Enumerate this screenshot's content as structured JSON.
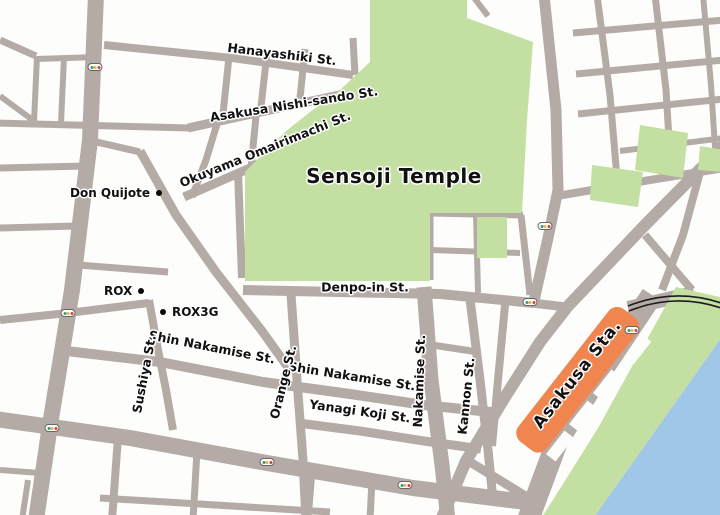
{
  "map": {
    "areas": {
      "temple_label": "Sensoji Temple",
      "station_label": "Asakusa Sta."
    },
    "street_labels": {
      "hanayashiki": "Hanayashiki St.",
      "nishisando": "Asakusa Nishi-sando St.",
      "okuyama": "Okuyama Omairimachi St.",
      "denpoin": "Denpo-in St.",
      "nakamise": "Nakamise St.",
      "shin_nakamise_left": "Shin Nakamise St.",
      "shin_nakamise_right": "Shin Nakamise St.",
      "yanagi_koji": "Yanagi Koji St.",
      "orange": "Orange St.",
      "kannon": "Kannon St.",
      "sushiya": "Sushiya St."
    },
    "pois": {
      "don_quijote": "Don Quijote",
      "rox": "ROX",
      "rox3g": "ROX3G"
    },
    "icons": {
      "traffic_signal": "traffic-light pill with green/yellow/red dots",
      "poi_marker": "black dot"
    },
    "colors": {
      "street": "#b5aba6",
      "block": "#fdfdfb",
      "park_green": "#c3dfa1",
      "water_blue": "#a0c6e8",
      "station_orange": "#f0854f",
      "railway_black": "#1c1c1c",
      "label_text": "#111111",
      "label_halo": "#ffffff"
    }
  }
}
